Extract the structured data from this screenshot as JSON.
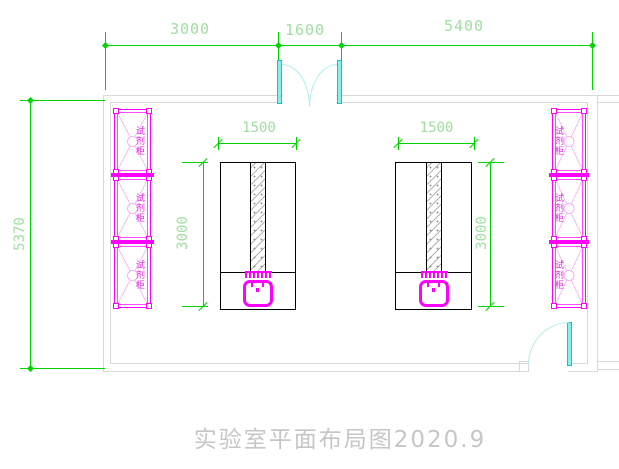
{
  "title": {
    "text": "实验室平面布局图2020.9"
  },
  "dimensions": {
    "top": [
      {
        "label": "3000"
      },
      {
        "label": "1600"
      },
      {
        "label": "5400"
      }
    ],
    "left_wall": {
      "label": "5370"
    },
    "bench_left": {
      "width": "1500",
      "depth": "3000"
    },
    "bench_right": {
      "width": "1500",
      "depth": "3000"
    }
  },
  "cabinets": {
    "label": "试剂柜"
  },
  "colors": {
    "dimension_line": "#00d400",
    "dimension_text": "#9fdf9f",
    "cabinet": "#ff00ff",
    "door": "#00cccc",
    "wall": "#d8d8d8",
    "bench_outline": "#000000",
    "title_text": "#c6c6c6"
  }
}
